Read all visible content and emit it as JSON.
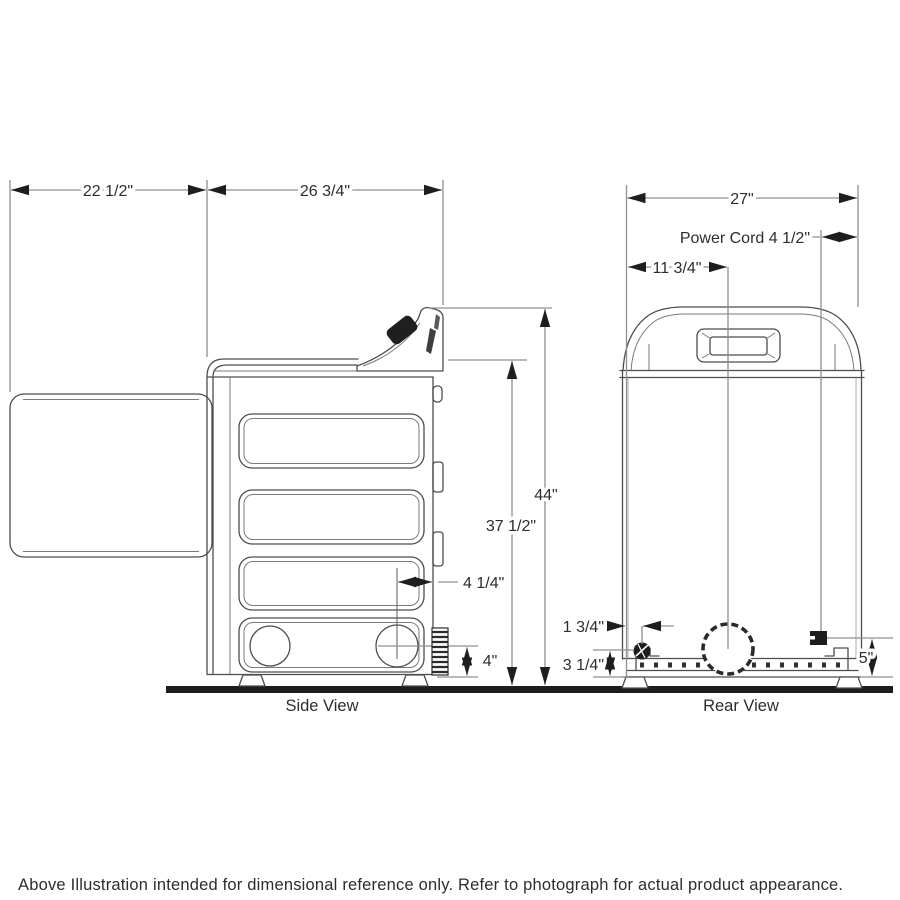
{
  "page": {
    "footer": "Above Illustration intended for dimensional reference only. Refer to photograph for actual product appearance."
  },
  "views": {
    "side_label": "Side View",
    "rear_label": "Rear View"
  },
  "dims": {
    "door_depth": "22 1/2\"",
    "cabinet_depth": "26 3/4\"",
    "width": "27\"",
    "power_cord": "Power Cord 4 1/2\"",
    "vent_center_offset": "11 3/4\"",
    "overall_height": "44\"",
    "cabinet_height": "37 1/2\"",
    "exhaust_from_rear": "4 1/4\"",
    "exhaust_height": "4\"",
    "gas_line_offset": "1 3/4\"",
    "gas_line_height": "3 1/4\"",
    "power_cord_height": "5\""
  },
  "colors": {
    "machine_line": "#4d4d4d",
    "dimension_line": "#8f8f8f",
    "arrowhead": "#1e1e1e",
    "text": "#2d2d2d",
    "floor": "#1d1d1d",
    "background": "#ffffff"
  }
}
